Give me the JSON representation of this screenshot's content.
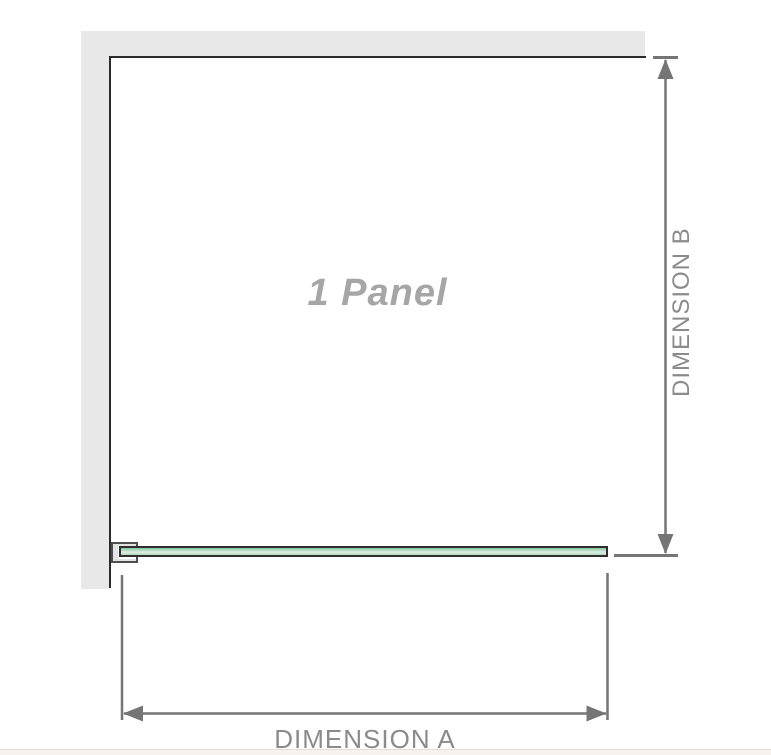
{
  "diagram": {
    "panel_label": "1 Panel",
    "dimension_a_label": "DIMENSION A",
    "dimension_b_label": "DIMENSION B"
  },
  "colors": {
    "wall": "#e8e8e8",
    "outline": "#2b2b2b",
    "dim-line": "#757575",
    "dim-text": "#8b8b8b",
    "panel-text": "#a6a6a6",
    "glass-border": "#2e2e2e",
    "glass-green-dark": "#86c29c",
    "glass-green-mid": "#b0d9bd",
    "glass-green-light": "#ddeee2",
    "clamp-fill": "#e3e3e3",
    "clamp-border": "#4f4f4f",
    "footer": "#f8f2ee",
    "footer-edge": "#e7dcd4"
  }
}
